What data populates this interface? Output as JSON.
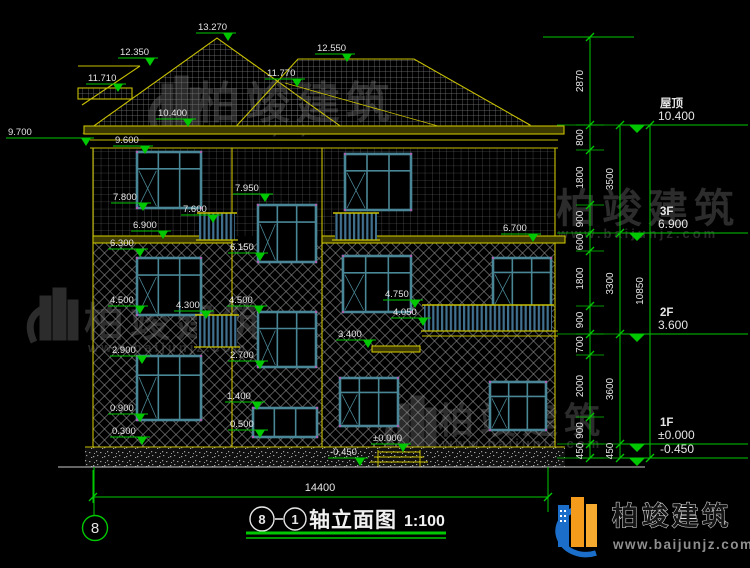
{
  "drawing_title": {
    "axis_start": "8",
    "axis_end": "1",
    "name": "轴立面图",
    "scale": "1:100"
  },
  "axis_bubbles": {
    "left": "8"
  },
  "brand": {
    "name": "柏竣建筑",
    "url": "www.baijunjz.com"
  },
  "dimensions": {
    "overall_width": "14400",
    "overall_height": "10850",
    "inner_chain": [
      "2870",
      "800",
      "1800",
      "900",
      "600",
      "1800",
      "900",
      "700",
      "2000",
      "900",
      "450"
    ],
    "mid_chain": [
      "3500",
      "3300",
      "3600",
      "450"
    ]
  },
  "floor_levels": [
    {
      "name": "屋顶",
      "value": "10.400"
    },
    {
      "name": "3F",
      "value": "6.900"
    },
    {
      "name": "2F",
      "value": "3.600"
    },
    {
      "name": "1F",
      "value": "±0.000"
    },
    {
      "name": "",
      "value": "-0.450"
    }
  ],
  "elevation_markers": [
    {
      "label": "13.270",
      "x": 198,
      "y": 30
    },
    {
      "label": "12.350",
      "x": 120,
      "y": 55
    },
    {
      "label": "11.710",
      "x": 88,
      "y": 81
    },
    {
      "label": "12.550",
      "x": 317,
      "y": 51
    },
    {
      "label": "11.770",
      "x": 267,
      "y": 76
    },
    {
      "label": "10.400",
      "x": 158,
      "y": 116
    },
    {
      "label": "9.700",
      "x": 8,
      "y": 135,
      "len": 88
    },
    {
      "label": "9.600",
      "x": 115,
      "y": 143
    },
    {
      "label": "7.800",
      "x": 113,
      "y": 200
    },
    {
      "label": "7.600",
      "x": 183,
      "y": 212
    },
    {
      "label": "7.950",
      "x": 235,
      "y": 191
    },
    {
      "label": "6.900",
      "x": 133,
      "y": 228
    },
    {
      "label": "6.300",
      "x": 110,
      "y": 246
    },
    {
      "label": "6.150",
      "x": 230,
      "y": 250
    },
    {
      "label": "6.700",
      "x": 503,
      "y": 231
    },
    {
      "label": "4.500",
      "x": 110,
      "y": 303
    },
    {
      "label": "4.300",
      "x": 176,
      "y": 308
    },
    {
      "label": "4.500",
      "x": 229,
      "y": 303
    },
    {
      "label": "4.750",
      "x": 385,
      "y": 297
    },
    {
      "label": "4.050",
      "x": 393,
      "y": 315
    },
    {
      "label": "3.400",
      "x": 338,
      "y": 337
    },
    {
      "label": "2.900",
      "x": 112,
      "y": 353
    },
    {
      "label": "2.700",
      "x": 230,
      "y": 358
    },
    {
      "label": "1.400",
      "x": 227,
      "y": 399
    },
    {
      "label": "0.900",
      "x": 110,
      "y": 411
    },
    {
      "label": "0.500",
      "x": 230,
      "y": 427
    },
    {
      "label": "0.300",
      "x": 112,
      "y": 434
    },
    {
      "label": "±0.000",
      "x": 373,
      "y": 441
    },
    {
      "label": "-0.450",
      "x": 330,
      "y": 455
    }
  ],
  "colors": {
    "cad_yellow": "#c8c000",
    "cad_green": "#00c800",
    "text_white": "#e5e5e5",
    "window_teal": "#4a8796",
    "railing_blue": "#41718f",
    "logo_blue": "#1b6ec9",
    "logo_orange": "#f59b1b",
    "watermark_gray": "#2c2c2c"
  }
}
